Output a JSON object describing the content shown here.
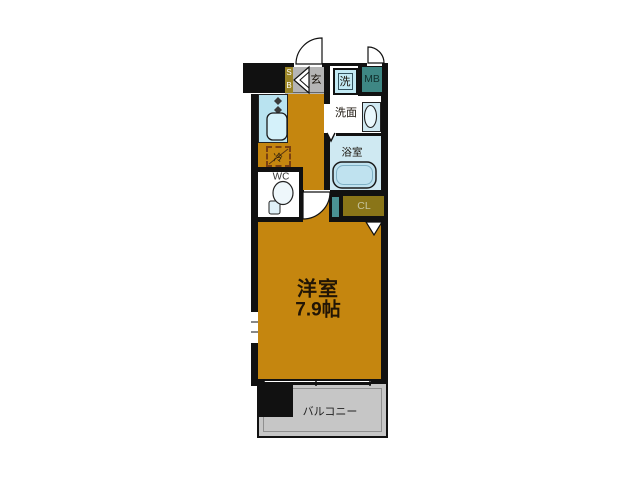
{
  "floorplan": {
    "rooms": {
      "main_room": {
        "name": "洋室",
        "size": "7.9帖"
      },
      "balcony": "バルコニー",
      "washroom": "洗面",
      "bathroom": "浴室",
      "toilet": "WC",
      "entrance": "玄",
      "closet": "CL",
      "shoe_box": "SB",
      "meter_box": "MB",
      "washing_machine": "洗",
      "refrigerator": "冷"
    },
    "colors": {
      "floor": "#c5860f",
      "entrance_floor": "#b5b5b5",
      "balcony_floor": "#c6c6c6",
      "wet_area": "#cfe9f2",
      "kitchen_counter": "#b9e3f0",
      "meter_box": "#3e8784",
      "pipe_space": "#4b9294",
      "closet": "#8a7518",
      "shoe_box": "#9a8426",
      "wall": "#111111"
    }
  }
}
